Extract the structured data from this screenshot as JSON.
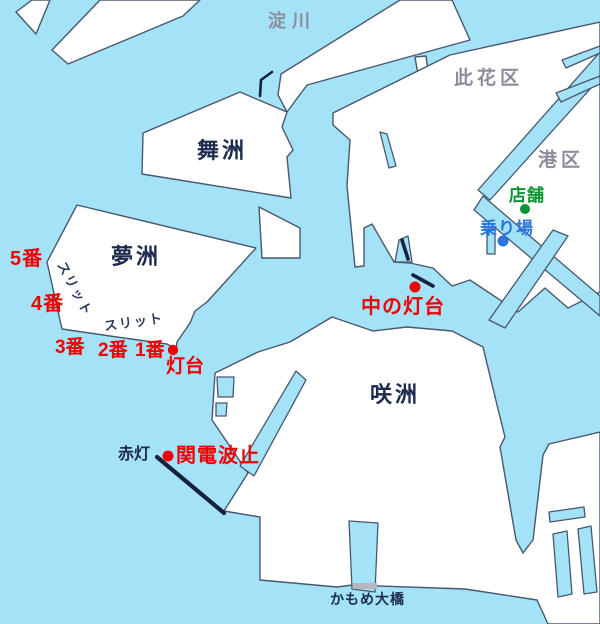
{
  "labels": {
    "yodogawa": "淀川",
    "konohana_ward": "此花区",
    "minato_ward": "港区",
    "maishima": "舞洲",
    "yumeshima": "夢洲",
    "sakishima": "咲洲",
    "slit_nw": "スリット",
    "slit_s": "スリット",
    "spot_5": "5番",
    "spot_4": "4番",
    "spot_3": "3番",
    "spot_2": "2番",
    "spot_1": "1番",
    "lighthouse": "灯台",
    "naka_lighthouse": "中の灯台",
    "red_light": "赤灯",
    "kanden_breakwater": "関電波止",
    "shop": "店舗",
    "boarding_point": "乗り場",
    "kamome_bridge": "かもめ大橋"
  },
  "colors": {
    "water": "#a4e2f8",
    "land": "#ffffff",
    "coastline": "#47586e",
    "island_label": "#1c2b4e",
    "ward_label": "#8c8c9c",
    "spot_red": "#f00000",
    "shop_green": "#0a9430",
    "boarding_blue": "#2a76dd",
    "bridge_gray": "#b6b6c0",
    "breakwater_black": "#16213c"
  }
}
